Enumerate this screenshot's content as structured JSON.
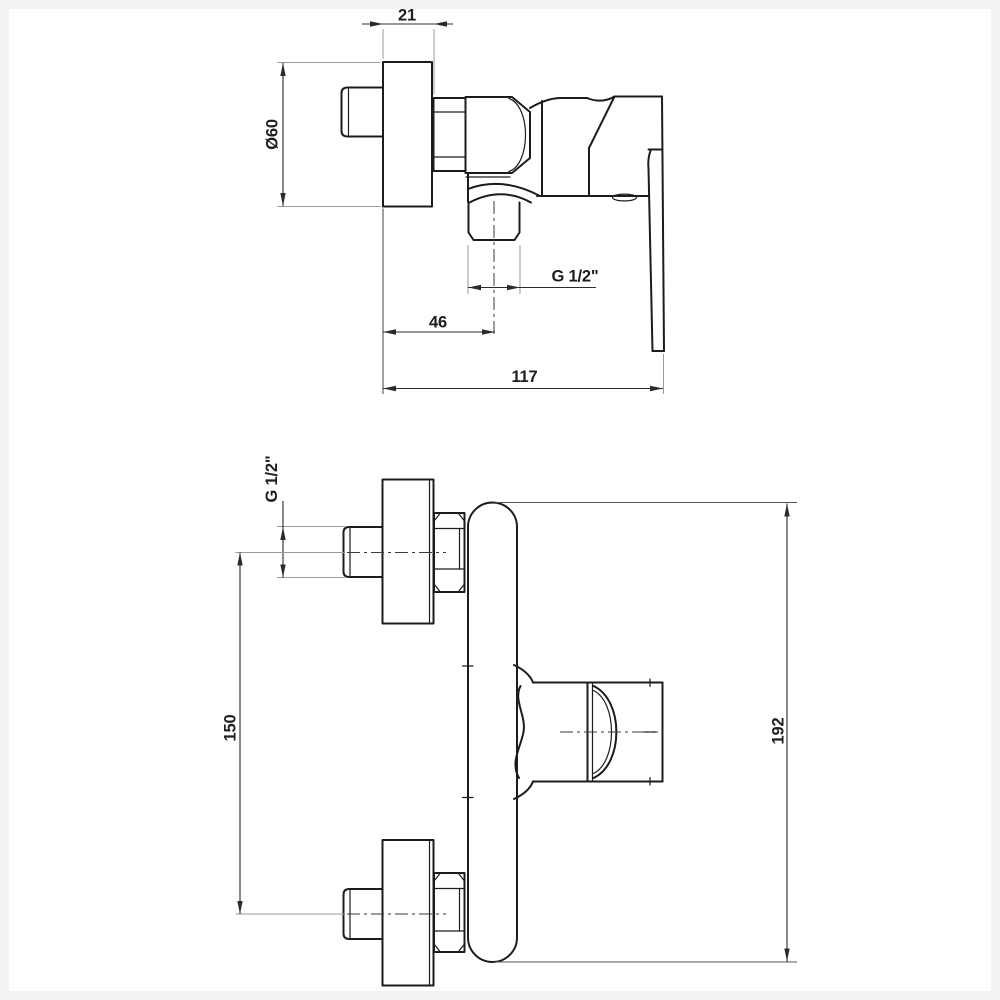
{
  "style": {
    "background": "#ffffff",
    "part_line": "#1c1c1c",
    "dimension_line": "#2b2b2b",
    "extension_line": "#9a9a9a",
    "frame": "#f3f3f3"
  },
  "side_view": {
    "dim_rosette_depth": "21",
    "dim_rosette_diameter": "Ø60",
    "dim_outlet_thread": "G 1/2\"",
    "dim_outlet_offset": "46",
    "dim_total_depth": "117"
  },
  "front_view": {
    "dim_inlet_thread": "G 1/2\"",
    "dim_inlet_spacing": "150",
    "dim_total_height": "192"
  }
}
